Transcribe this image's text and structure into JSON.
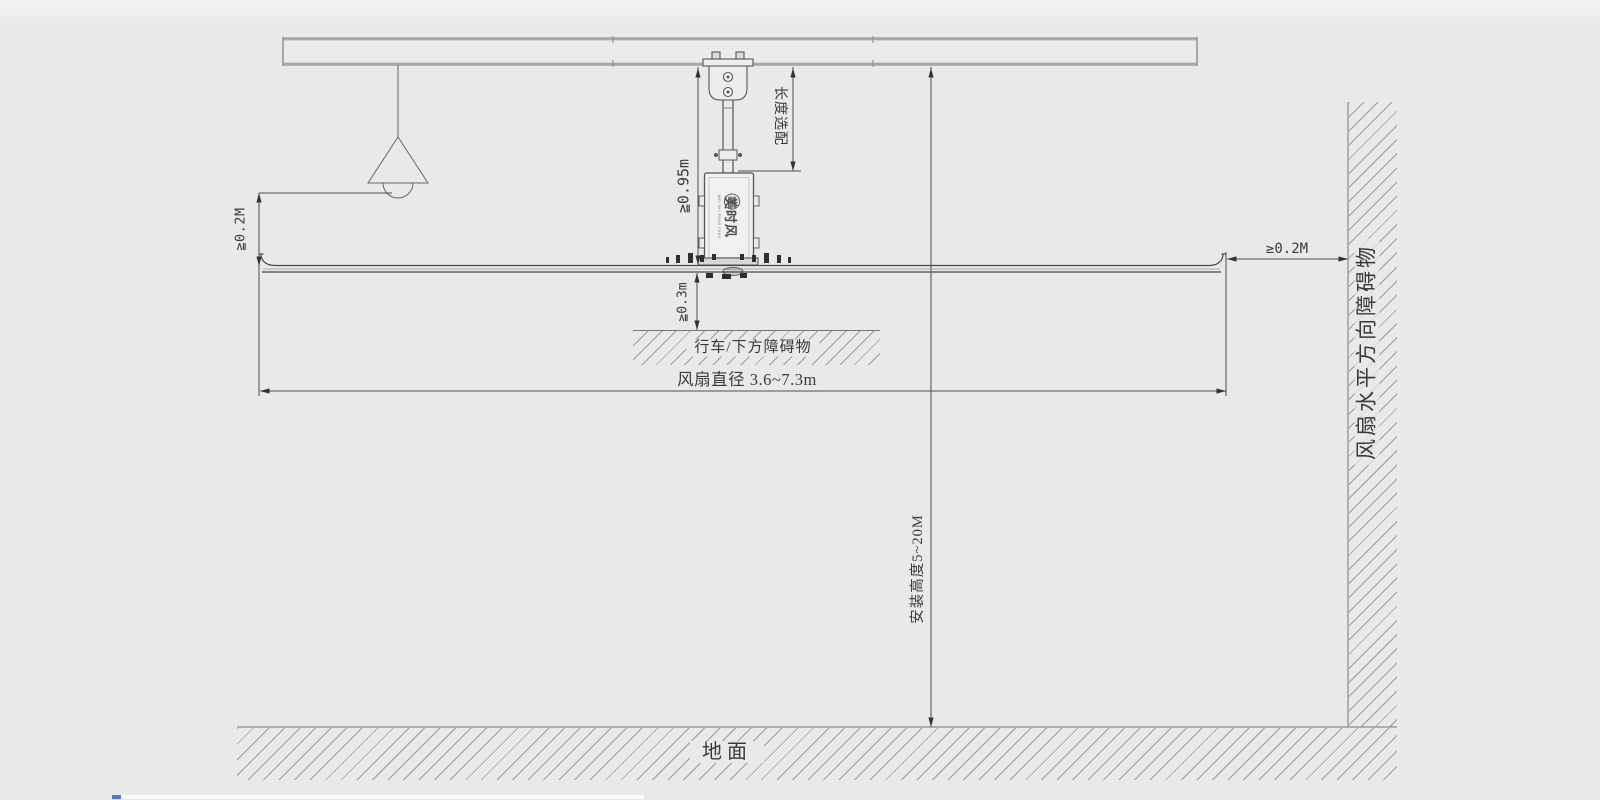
{
  "scene": {
    "background": "#e9e9e9",
    "ink": "#4d4d4d",
    "beam_color": "#a6a6a6",
    "hatch_color": "#9b9b9b",
    "text_color": "#3a3a3a",
    "edge_strip": "#fbfbfb",
    "edge_accent": "#4f7bd6"
  },
  "dimensions": {
    "left_clearance": "≧0.2M",
    "hanger_min_height": "≧0.95m",
    "drop_rod_length": "长度选配",
    "blade_to_obstacle": "≧0.3m",
    "fan_diameter": "风扇直径 3.6~7.3m",
    "install_height": "安装高度5~20M",
    "right_clearance": "≥0.2M"
  },
  "annotations": {
    "lower_obstacle": "行车/下方障碍物",
    "side_obstacle": "风扇水平方向障碍物",
    "ground": "地面"
  },
  "motor_logo": {
    "brand": "美时风",
    "subtext": "MEI SHI FENG FANS"
  }
}
